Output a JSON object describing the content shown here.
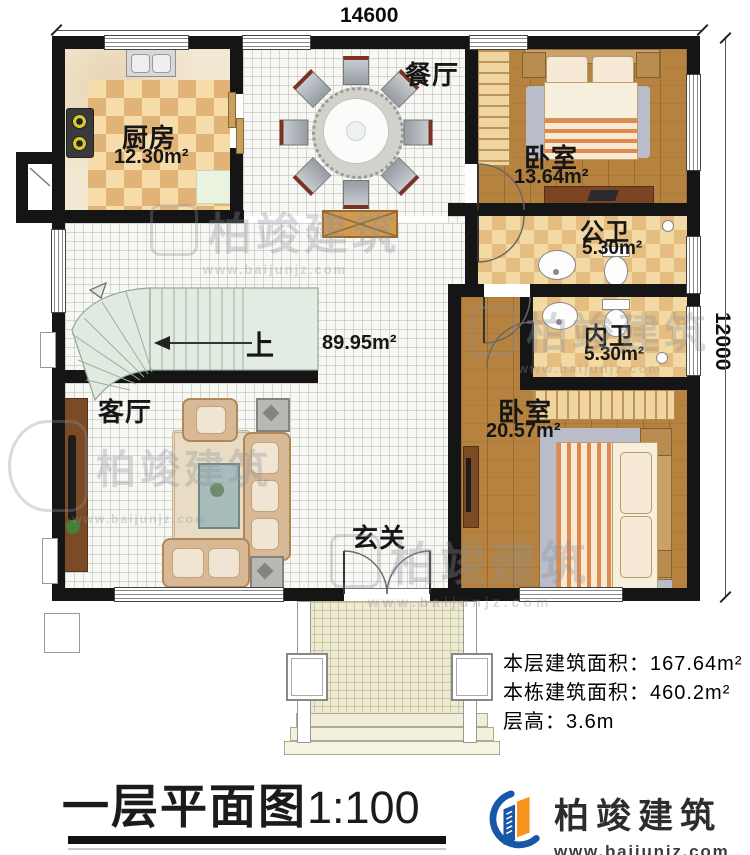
{
  "title": {
    "text": "一层平面图",
    "scale": "1:100"
  },
  "dim": {
    "width": "14600",
    "height": "12000"
  },
  "rooms": {
    "kitchen": {
      "name": "厨房",
      "area": "12.30m²"
    },
    "dining": {
      "name": "餐厅"
    },
    "bedroom1": {
      "name": "卧室",
      "area": "13.64m²"
    },
    "public_bath": {
      "name": "公卫",
      "area": "5.30m²"
    },
    "private_bath": {
      "name": "内卫",
      "area": "5.30m²"
    },
    "bedroom2": {
      "name": "卧室",
      "area": "20.57m²"
    },
    "living": {
      "name": "客厅"
    },
    "foyer": {
      "name": "玄关"
    }
  },
  "labels": {
    "up": "上",
    "open_area": "89.95m²"
  },
  "notes": {
    "floor_label": "本层建筑面积：",
    "floor_value": "167.64m²",
    "total_label": "本栋建筑面积：",
    "total_value": "460.2m²",
    "height_label": "层高：",
    "height_value": "3.6m"
  },
  "logo": {
    "name": "柏竣建筑",
    "site": "www.baijunjz.com"
  },
  "watermark": {
    "name": "柏竣建筑",
    "site": "www.baijunjz.com"
  },
  "colors": {
    "wall": "#151515",
    "wood": "#b5823f",
    "check_light": "#f6dca9",
    "check_dark": "#e2b377",
    "stairs": "#e0eae0",
    "logo_blue": "#1857a8",
    "logo_orange": "#f7941d"
  }
}
